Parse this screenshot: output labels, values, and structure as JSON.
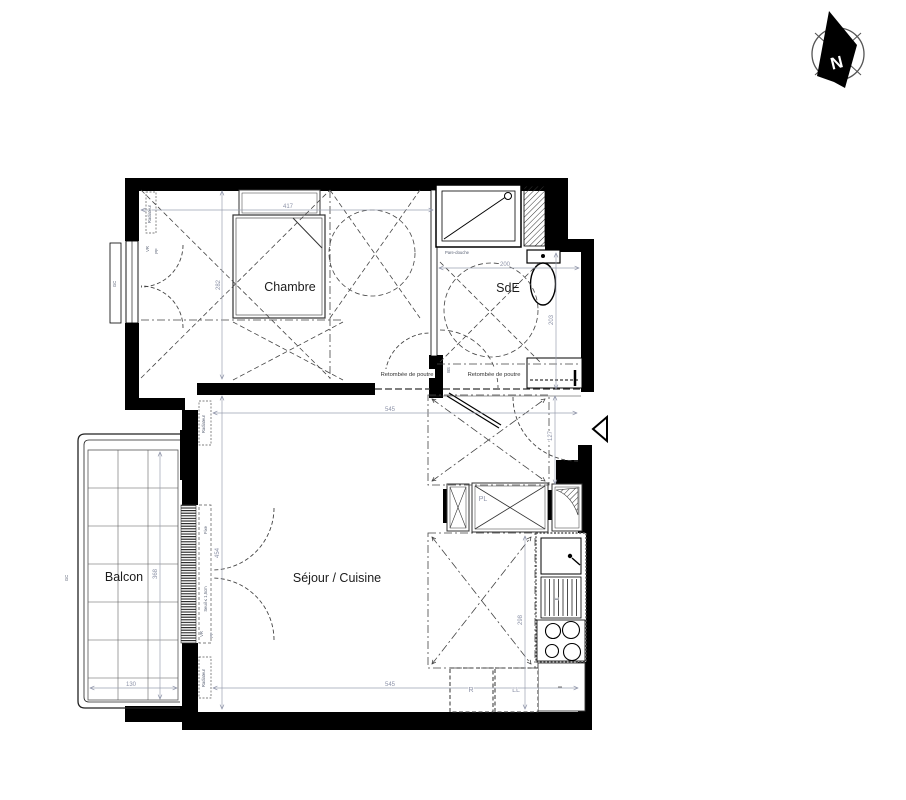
{
  "compass": {
    "label": "N"
  },
  "rooms": {
    "chambre": "Chambre",
    "sde": "SdE",
    "sejour": "Séjour / Cuisine",
    "balcon": "Balcon"
  },
  "labels": {
    "beam": "Retombée de poutre",
    "pare_douche": "Pare-douche",
    "fixe": "Fixe",
    "seuil": "Seuil ≤ 1,5cm",
    "vr": "VR",
    "pf": "PF",
    "gc": "GC",
    "bs": "BS",
    "pl": "PL",
    "fridge": "R",
    "washer": "LL",
    "sink": "E",
    "radiator": "Radiateur"
  },
  "dims": {
    "chambre_width": "417",
    "chambre_height": "282",
    "sde_width": "200",
    "sde_height": "203",
    "hall_height": "127",
    "sejour_width_top": "545",
    "sejour_width_bottom": "545",
    "sejour_height": "454",
    "kitchen_height": "298",
    "balcon_width": "130",
    "balcon_height": "368"
  }
}
